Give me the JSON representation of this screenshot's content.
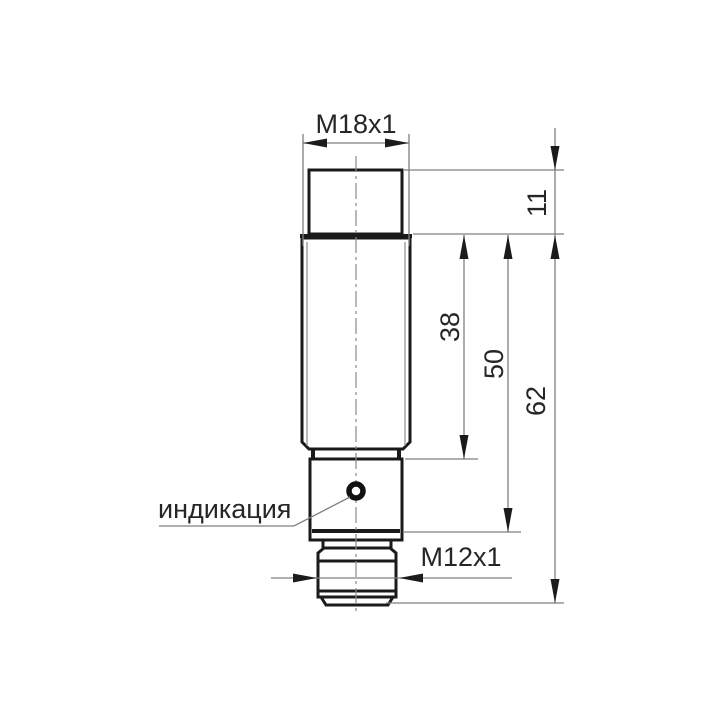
{
  "drawing": {
    "labels": {
      "thread_top": "M18x1",
      "connector_thread": "M12x1",
      "indicator": "индикация"
    },
    "dimensions": [
      {
        "name": "cap-height",
        "value": "11"
      },
      {
        "name": "thread-length",
        "value": "38"
      },
      {
        "name": "housing-length",
        "value": "50"
      },
      {
        "name": "total-length",
        "value": "62"
      }
    ],
    "colors": {
      "background": "#ffffff",
      "part_outline": "#1a1a1a",
      "dimension_lines": "#7f7f7f",
      "text": "#262626"
    }
  }
}
